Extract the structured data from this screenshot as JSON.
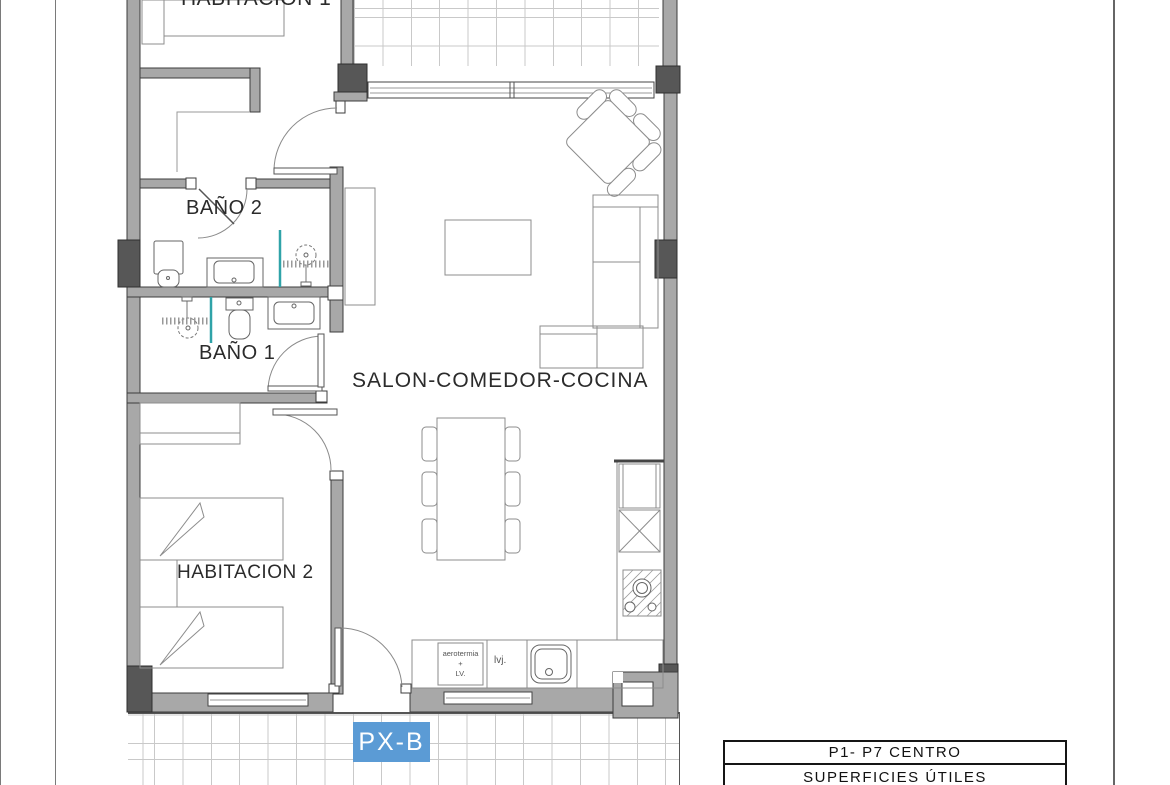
{
  "rooms": {
    "bedroom1": "HABITACION 1",
    "bathroom2": "BAÑO 2",
    "bathroom1": "BAÑO 1",
    "living": "SALON-COMEDOR-COCINA",
    "bedroom2": "HABITACION 2"
  },
  "tags": {
    "plan_code": "PX-B"
  },
  "kitchen": {
    "aero_line1": "aerotermia",
    "aero_line2": "+",
    "aero_line3": "LV.",
    "dishwasher": "lvj."
  },
  "title_block": {
    "rows": [
      "P1- P7 CENTRO",
      "SUPERFICIES ÚTILES"
    ]
  },
  "colors": {
    "wall": "#a8a8a8",
    "pillar": "#575757",
    "tag_bg": "#5b9bd5",
    "glass": "#2fa3a8"
  }
}
